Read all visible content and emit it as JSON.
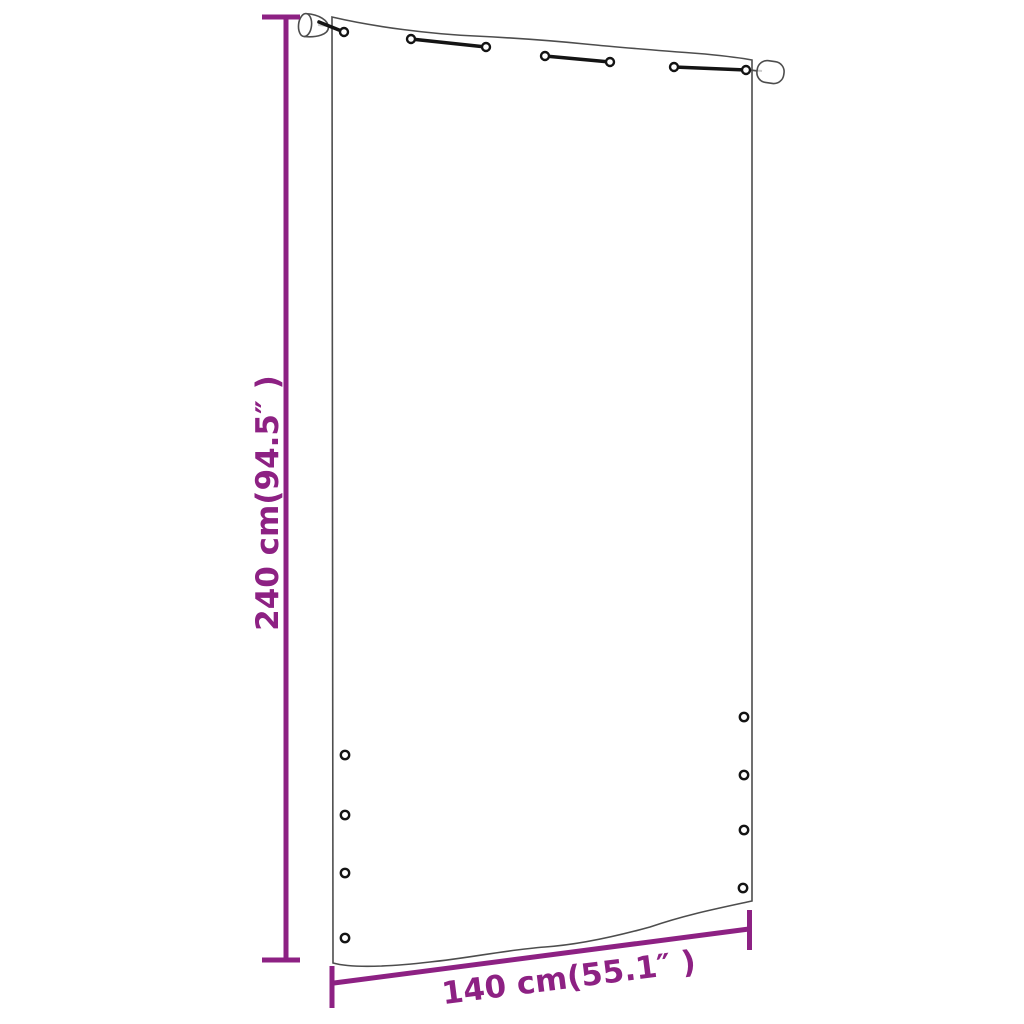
{
  "diagram": {
    "name": "balcony-screen-dimension-diagram",
    "height_label": "240 cm(94.5″ )",
    "width_label": "140 cm(55.1″ )",
    "grommets_left_count": 4,
    "grommets_right_count": 4,
    "tie_straps_count": 3
  },
  "colors": {
    "dimension": "#8d2183",
    "outline": "#4d4d4d",
    "hardware": "#141414",
    "rod_faint": "#cccccc",
    "background": "#ffffff"
  }
}
